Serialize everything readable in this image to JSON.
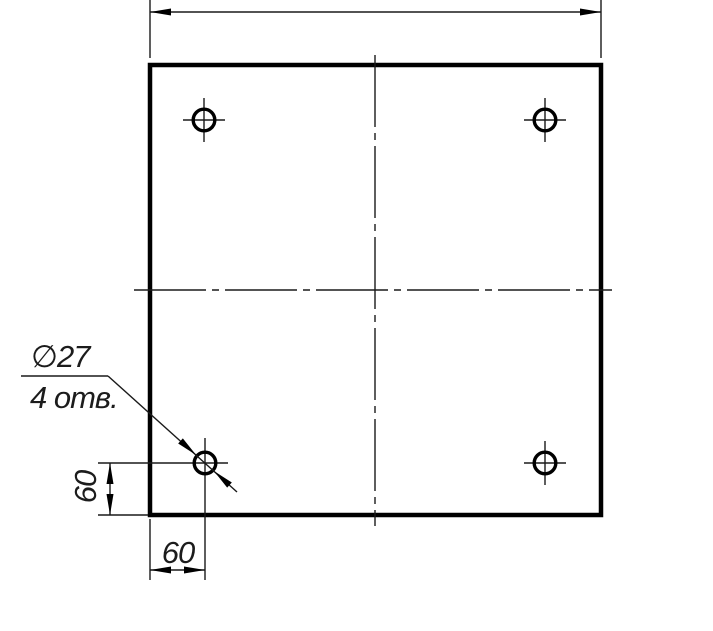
{
  "drawing": {
    "type": "engineering-drawing",
    "colors": {
      "line": "#000000",
      "background": "#ffffff"
    },
    "callout": {
      "diameter": "∅27",
      "count": "4 отв."
    },
    "dimensions": {
      "vertical_offset": "60",
      "horizontal_offset": "60"
    }
  }
}
